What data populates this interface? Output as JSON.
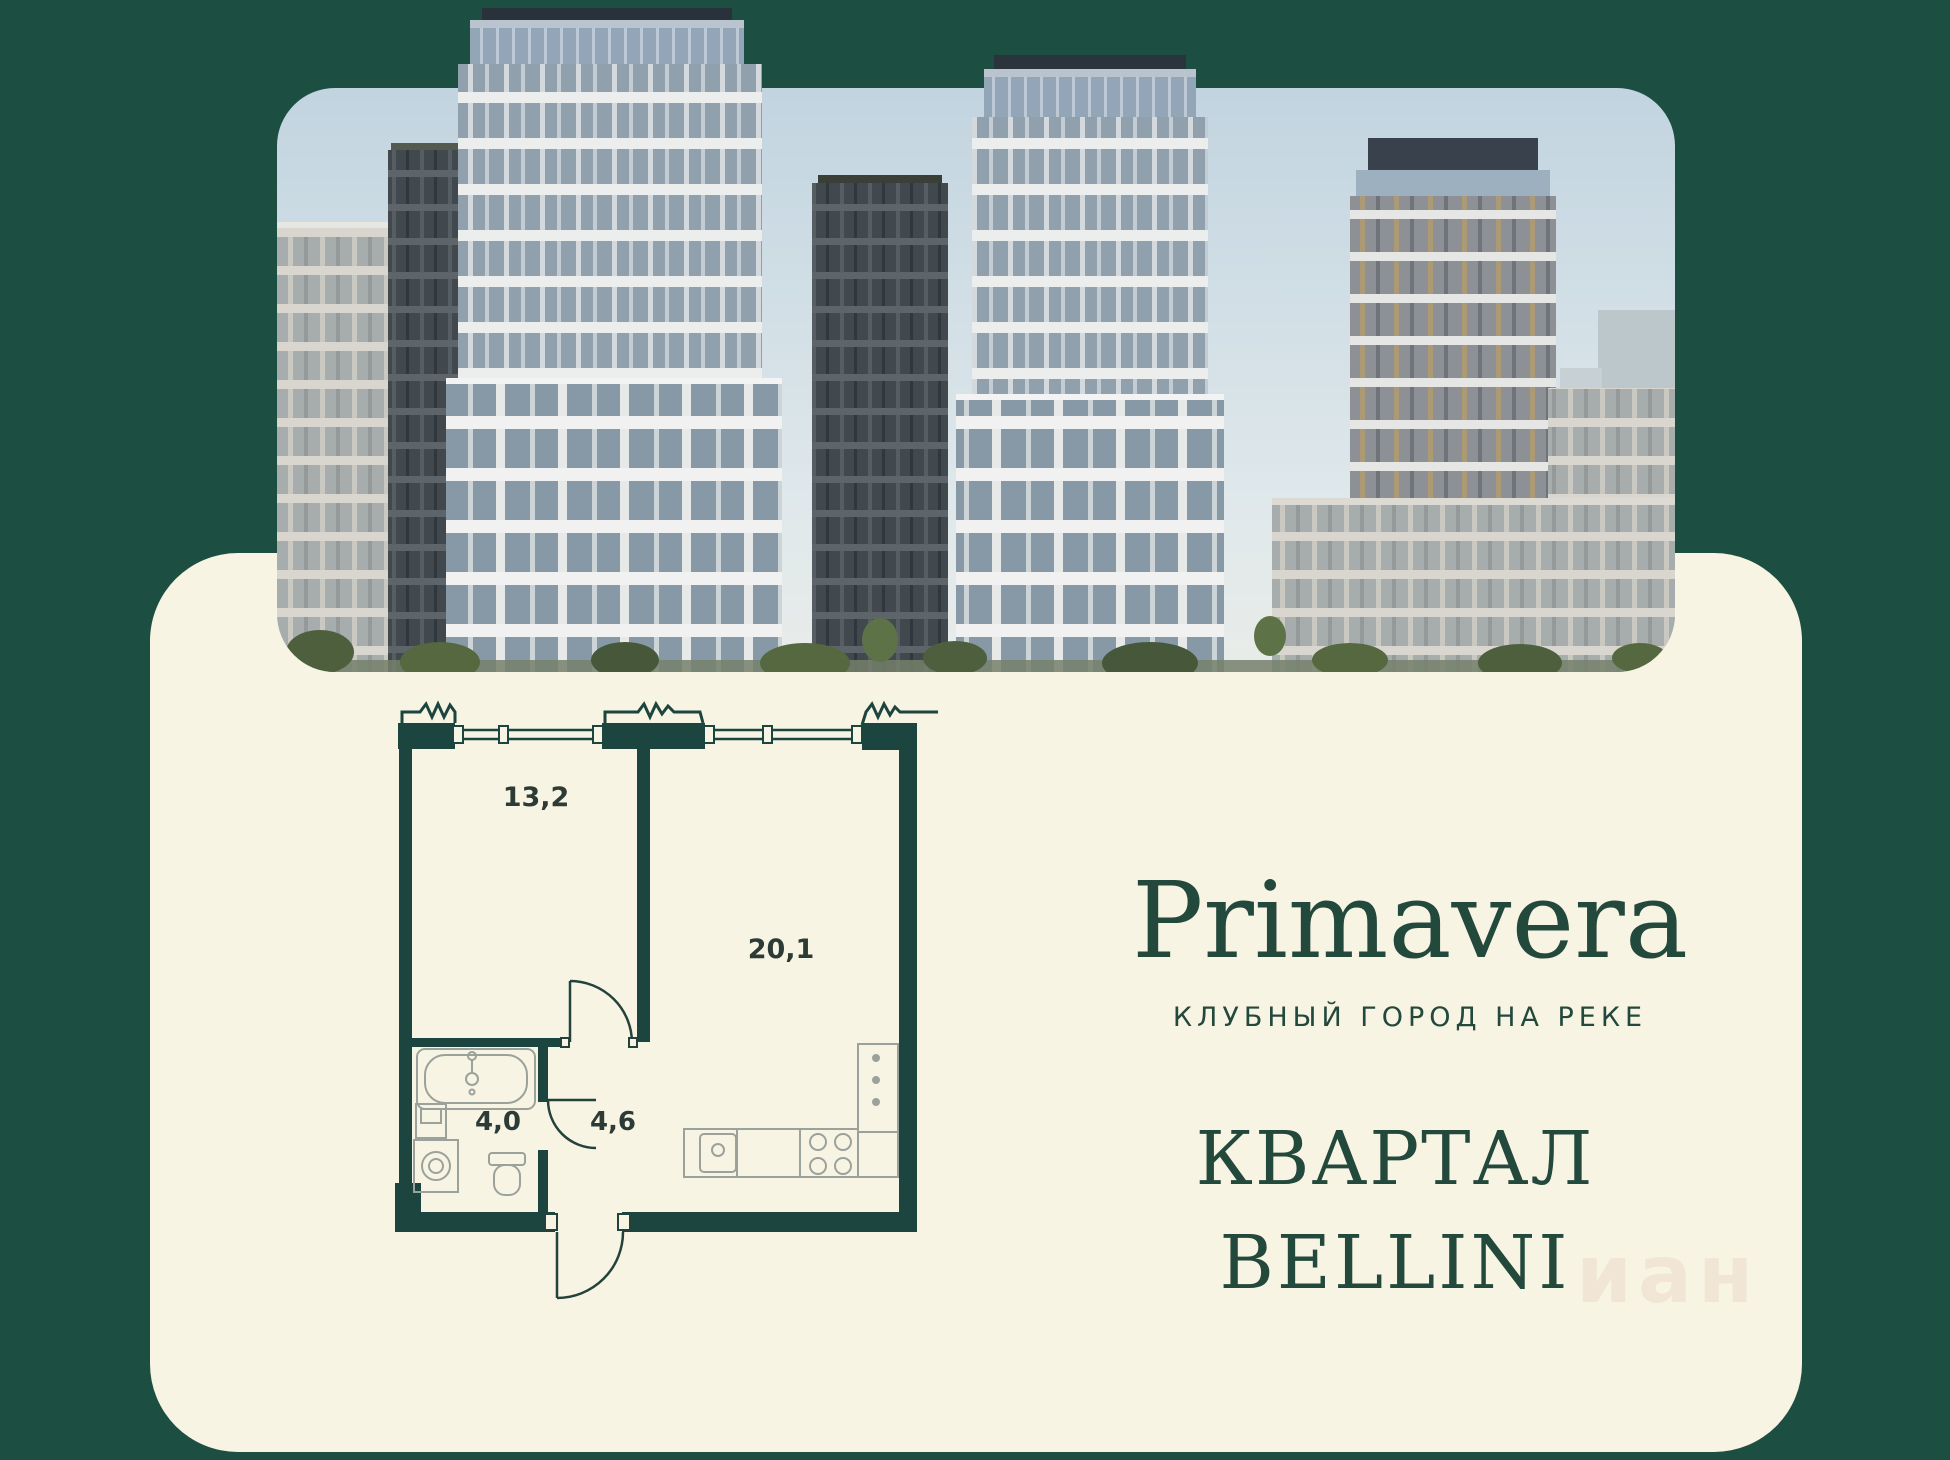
{
  "brand": {
    "logo": "Primavera",
    "tagline": "КЛУБНЫЙ ГОРОД НА РЕКЕ"
  },
  "quarter": {
    "line1": "КВАРТАЛ",
    "line2": "BELLINI"
  },
  "floor_plan": {
    "rooms": [
      {
        "label": "13,2"
      },
      {
        "label": "20,1"
      },
      {
        "label": "4,0"
      },
      {
        "label": "4,6"
      }
    ]
  },
  "watermark": {
    "text": "иан"
  },
  "colors": {
    "background_green": "#1c4f42",
    "card_cream": "#f8f4e3",
    "brand_green": "#23483c",
    "plan_wall_green": "#1b453e"
  }
}
